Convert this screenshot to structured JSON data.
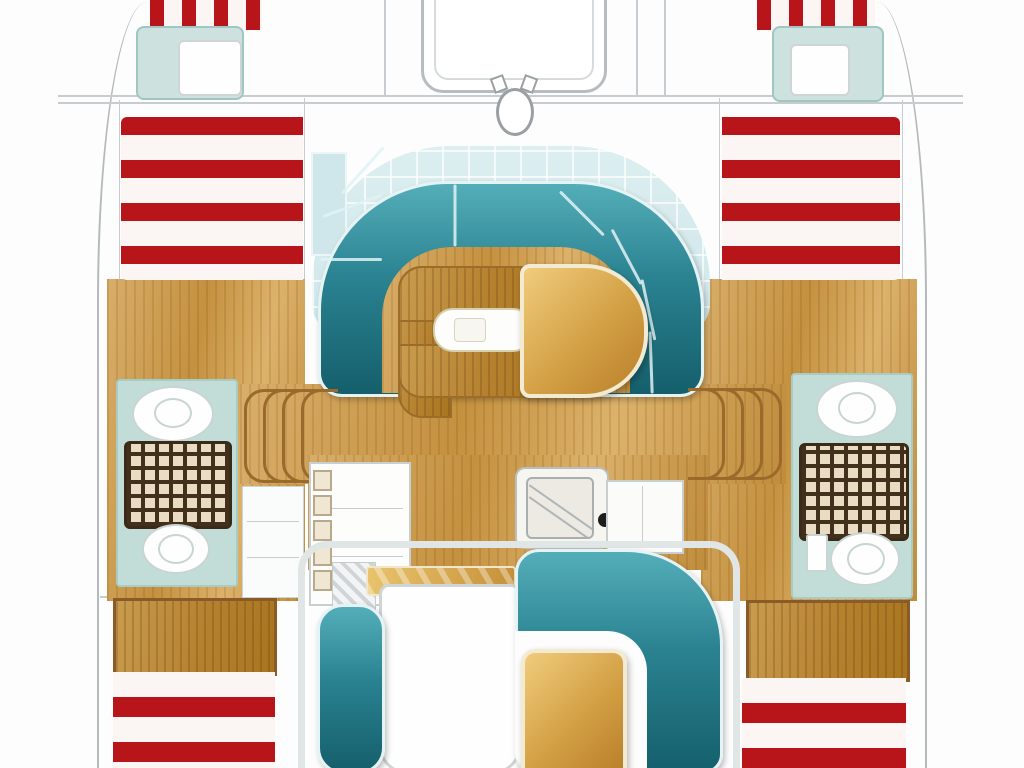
{
  "diagram": {
    "title": "Catamaran interior and deck floor plan, top view, bow at top",
    "type": "boat-floor-plan",
    "orientation": "bow-top",
    "areas": {
      "bow": {
        "trampoline": "foredeck platform",
        "windlass": "anchor windlass fitting",
        "port_bow_berth": "forepeak berth with white pillow and red striped cushion",
        "starboard_bow_berth": "forepeak berth with white pillow and red striped cushion"
      },
      "foredeck": {
        "port_sunpad": "red and white striped sun cushion",
        "starboard_sunpad": "red and white striped sun cushion"
      },
      "salon": {
        "settee": "U-shaped teal upholstered settee",
        "table": "wooden U bench table with white inset",
        "d_table": "D-shaped varnished wood table",
        "windows": "pale blue wraparound glazing"
      },
      "galley": {
        "port_counter": "white counter with locker row",
        "sink": "square sink with drainer",
        "stove_knob": "black control knob",
        "starboard_counter": "white worktop"
      },
      "heads": {
        "port": [
          "washbasin",
          "teak shower grating",
          "toilet"
        ],
        "starboard": [
          "washbasin",
          "teak shower grating",
          "toilet",
          "cistern"
        ]
      },
      "companionways": {
        "port_steps": "four curved steps down into port hull",
        "starboard_steps": "four curved steps down into starboard hull"
      },
      "cockpit": {
        "frame": "moulded cockpit coaming",
        "port_bench": "teal bench seat",
        "table_white": "white cockpit module",
        "ledge": "gold varnished ledge",
        "settee": "L-shaped teal cockpit settee",
        "gold_table": "square varnished cockpit table"
      },
      "stern": {
        "port_berth": "wood berth panel with red striped cushion",
        "starboard_berth": "wood berth panel with red striped cushion"
      }
    },
    "colors": {
      "red": "#b8151b",
      "stripe-white": "#fbf6f3",
      "teal-light": "#54aeb9",
      "teal-mid": "#2a8290",
      "teal-dark": "#155f6c",
      "teal-pale": "#c2dcd8",
      "glass": "#dceef0",
      "wood-light": "#d8ae6a",
      "wood-mid": "#c4913f",
      "wood-edge": "#9c6d2a",
      "gold-light": "#f0cc7c",
      "gold-mid": "#d3a045",
      "gold-dark": "#b97f2a",
      "grate-brown": "#43301c",
      "grate-cream": "#e9dcc2",
      "outline": "#b4babc",
      "frame": "#e0e5e6",
      "knob": "#1d1d1d",
      "pillow-white": "#fefefe"
    }
  }
}
